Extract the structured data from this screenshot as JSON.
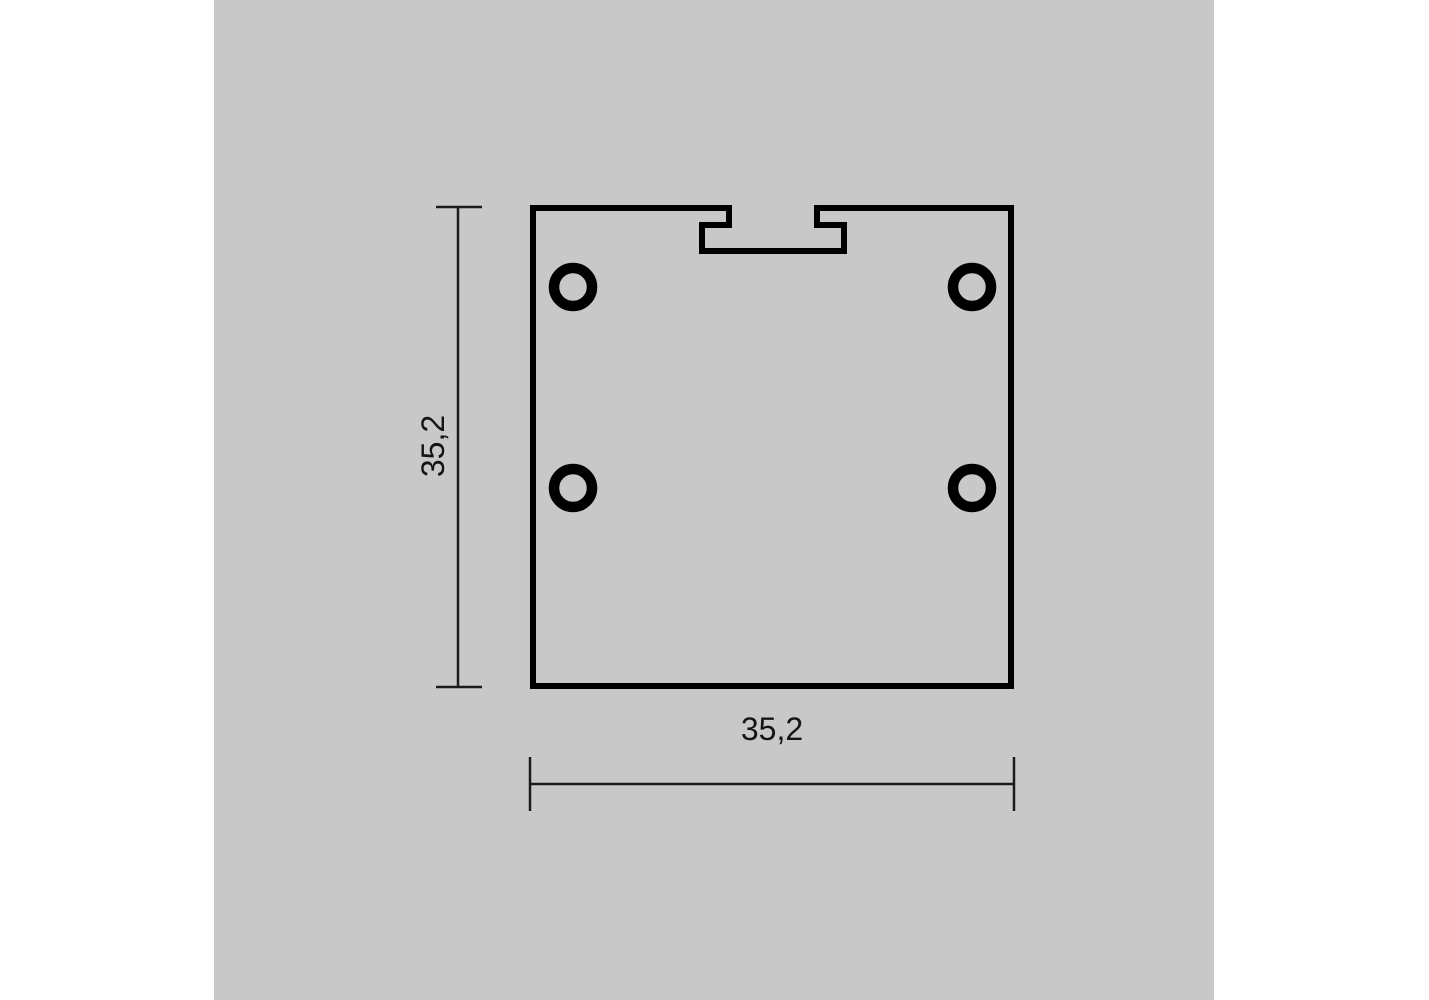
{
  "title": "Square profile cross-section technical drawing",
  "colors": {
    "page_background": "#ffffff",
    "panel_background": "#c8c8c8",
    "outline": "#000000",
    "dimension": "#1c1c1c",
    "label": "#141414"
  },
  "drawing": {
    "profile": {
      "description": "square extrusion profile with T-slot groove at top center",
      "holes_count": "4"
    },
    "dimensions": {
      "height": {
        "label": "35,2"
      },
      "width": {
        "label": "35,2"
      }
    }
  }
}
